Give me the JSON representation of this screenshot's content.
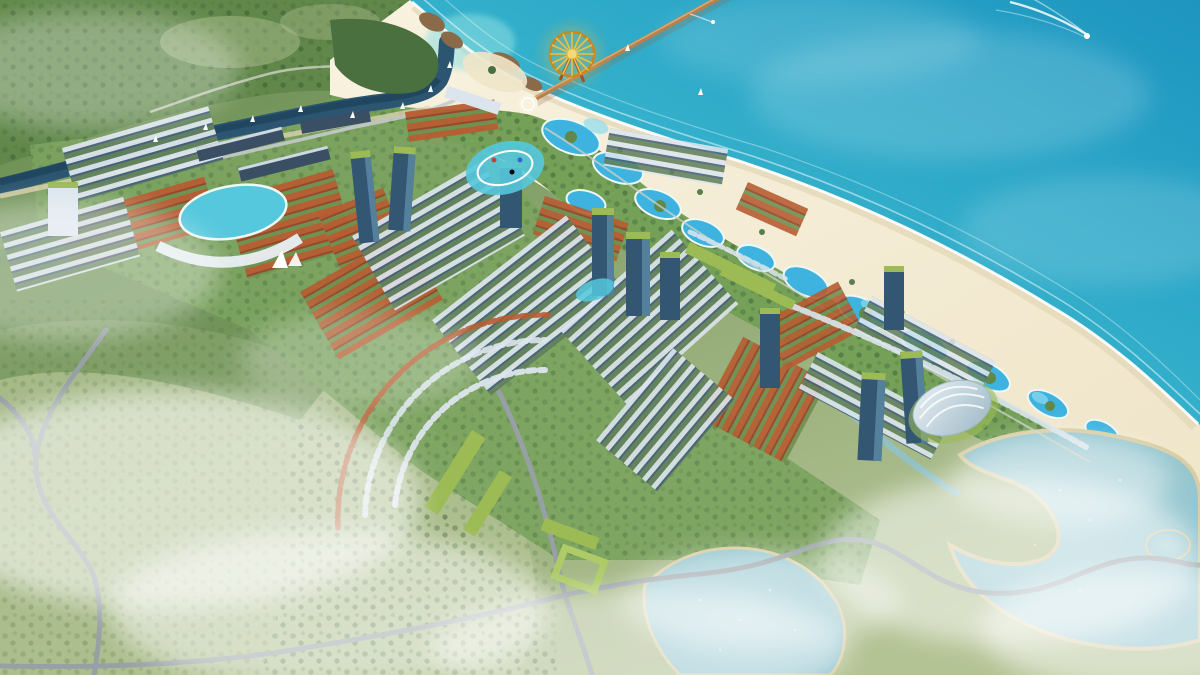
{
  "colors": {
    "ocean_deep": "#1d95c0",
    "ocean_mid": "#36b3cd",
    "ocean_shallow": "#74d8de",
    "shallow_cove": "#8fdfe0",
    "foam": "#ffffff",
    "sand": "#efe5c9",
    "sand_wet": "#e2d6b6",
    "sand_bright": "#f8f2df",
    "coast_green": "#74a058",
    "palm_green": "#3f6b35",
    "land_green": "#8fa873",
    "field_light": "#b4c394",
    "forest_dark": "#4a7040",
    "forest_mid": "#61884a",
    "dev_ground": "#7ba35f",
    "lagoon": "#3eb3e0",
    "lagoon_light": "#8edcee",
    "lagoon_rim": "#eef8f6",
    "river": "#2b5570",
    "river_deep": "#1d4258",
    "lake": "#8fc2cc",
    "lake_shore": "#d8cda4",
    "road": "#97a0a5",
    "road_light": "#c4cacc",
    "path_light": "#cfd2c6",
    "roof_orange": "#b85c32",
    "roof_orange_dark": "#94462a",
    "row_gap_green": "#6f9150",
    "roof_white": "#dce5ed",
    "wall_dark": "#45607a",
    "row_gap_dark": "#62805c",
    "tower_body": "#335672",
    "tower_glass": "#55809c",
    "roof_green": "#9cbb55",
    "green_roof_light": "#aecb67",
    "pool_aqua": "#55c8dd",
    "ferris_gold": "#eec043",
    "ferris_rim": "#c8871f",
    "ferris_hub": "#f6d878",
    "pier": "#b5814f",
    "pier_light": "#d9a873",
    "dome_white": "#e9f0f4",
    "dome_shade": "#9db8c6",
    "rock_brown": "#8a6a48",
    "boat_white": "#ffffff",
    "mist": "#ffffff",
    "gate_white": "#ffffff",
    "support_brown": "#a0522d"
  }
}
